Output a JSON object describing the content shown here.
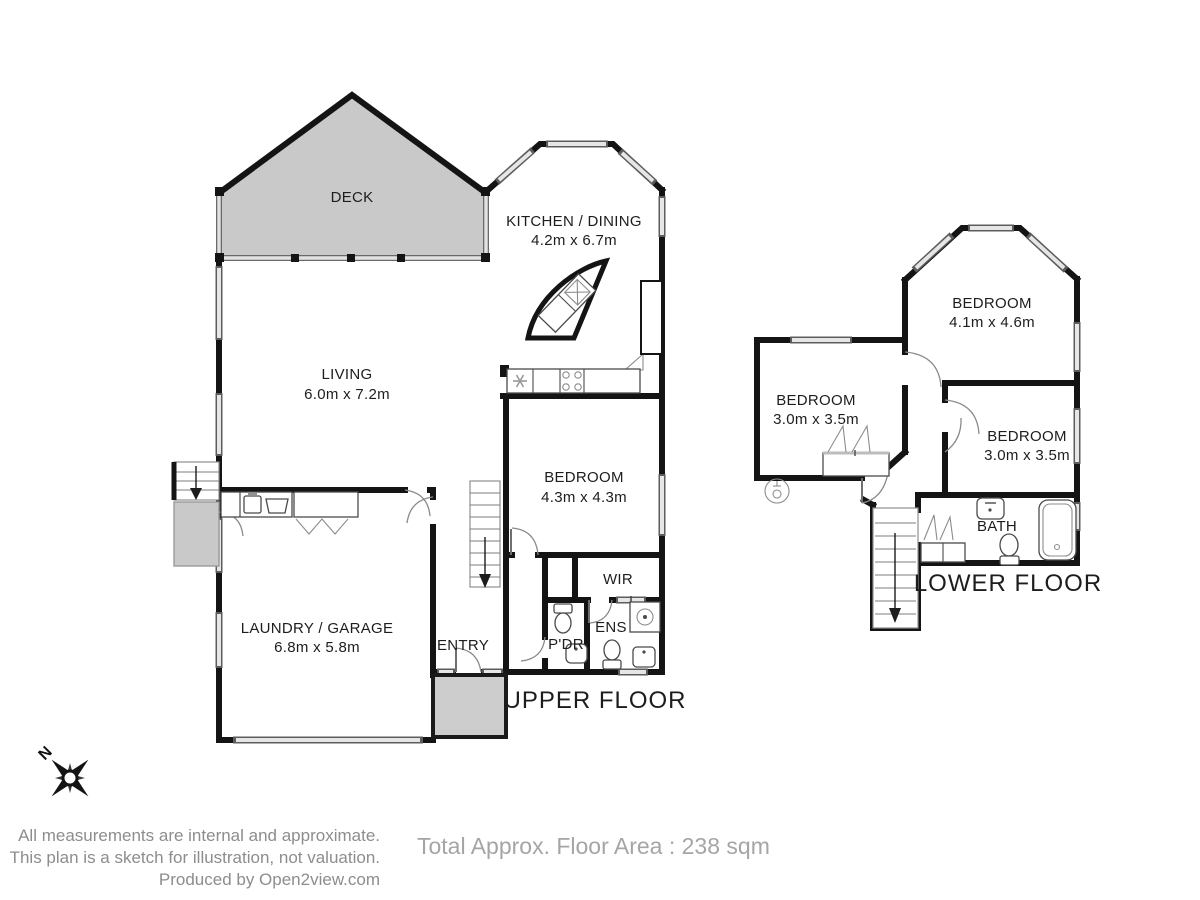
{
  "upper": {
    "title": "UPPER FLOOR",
    "rooms": {
      "deck": {
        "label": "DECK"
      },
      "kitchen": {
        "label": "KITCHEN / DINING",
        "dims": "4.2m x 6.7m"
      },
      "living": {
        "label": "LIVING",
        "dims": "6.0m x 7.2m"
      },
      "bedroom": {
        "label": "BEDROOM",
        "dims": "4.3m x 4.3m"
      },
      "wir": {
        "label": "WIR"
      },
      "ens": {
        "label": "ENS"
      },
      "pdr": {
        "label": "P'DR"
      },
      "entry": {
        "label": "ENTRY"
      },
      "laundry_garage": {
        "label": "LAUNDRY / GARAGE",
        "dims": "6.8m x 5.8m"
      }
    }
  },
  "lower": {
    "title": "LOWER FLOOR",
    "rooms": {
      "bedroom_main": {
        "label": "BEDROOM",
        "dims": "4.1m x 4.6m"
      },
      "bedroom_left": {
        "label": "BEDROOM",
        "dims": "3.0m x 3.5m"
      },
      "bedroom_right": {
        "label": "BEDROOM",
        "dims": "3.0m x 3.5m"
      },
      "bath": {
        "label": "BATH"
      }
    }
  },
  "compass": {
    "north_label": "N"
  },
  "footer": {
    "disclaimer_line1": "All measurements are internal and approximate.",
    "disclaimer_line2": "This plan is a sketch for illustration, not valuation.",
    "disclaimer_line3": "Produced by Open2view.com",
    "total_area": "Total Approx. Floor Area : 238 sqm"
  },
  "colors": {
    "wall": "#141414",
    "area_fill": "#c9c9c9",
    "muted_text": "#8d8d8d",
    "total_text": "#a5a5a5"
  }
}
